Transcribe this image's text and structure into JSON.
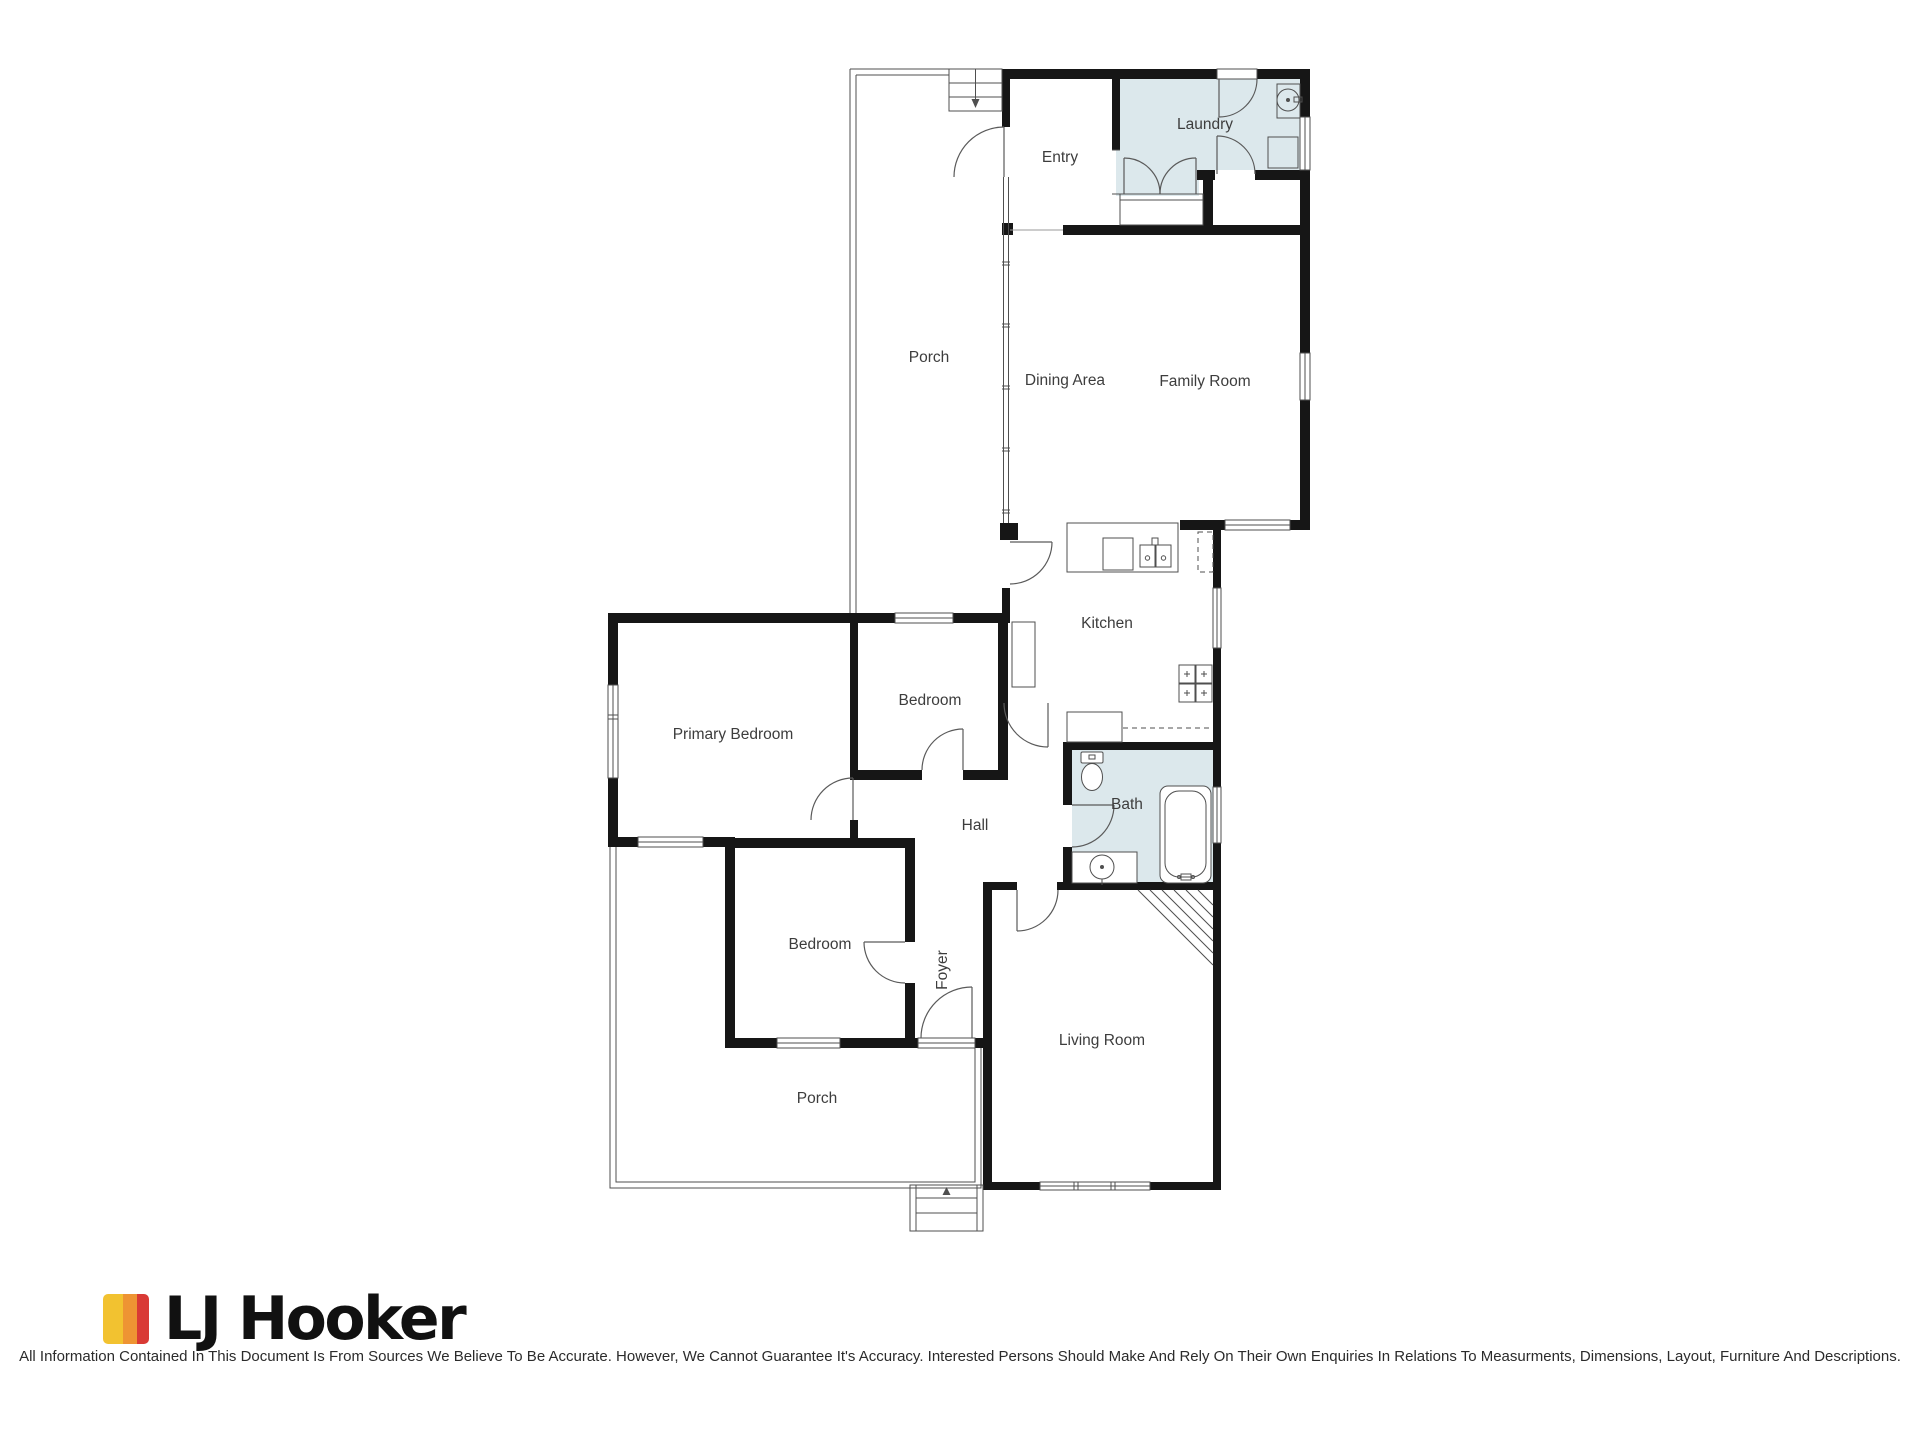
{
  "floorplan": {
    "rooms": [
      {
        "name": "porch-upper",
        "label": "Porch"
      },
      {
        "name": "entry",
        "label": "Entry"
      },
      {
        "name": "laundry",
        "label": "Laundry"
      },
      {
        "name": "dining-area",
        "label": "Dining Area"
      },
      {
        "name": "family-room",
        "label": "Family Room"
      },
      {
        "name": "kitchen",
        "label": "Kitchen"
      },
      {
        "name": "primary-bedroom",
        "label": "Primary Bedroom"
      },
      {
        "name": "bedroom-middle",
        "label": "Bedroom"
      },
      {
        "name": "hall",
        "label": "Hall"
      },
      {
        "name": "bath",
        "label": "Bath"
      },
      {
        "name": "bedroom-lower",
        "label": "Bedroom"
      },
      {
        "name": "foyer",
        "label": "Foyer"
      },
      {
        "name": "living-room",
        "label": "Living Room"
      },
      {
        "name": "porch-lower",
        "label": "Porch"
      }
    ],
    "fixtures": [
      "stairs-down",
      "front-steps",
      "corner-stairs",
      "toilet",
      "bathtub",
      "vanity-sink",
      "kitchen-double-sink",
      "stove",
      "cooktop",
      "refrigerator",
      "dishwasher",
      "laundry-sink",
      "washer",
      "linen-closet"
    ],
    "colors": {
      "wall": "#161616",
      "wet_room_fill": "#dce8ec",
      "line": "#4f4f4f",
      "label": "#3d3d3d"
    }
  },
  "footer": {
    "brand": {
      "name": "LJ Hooker",
      "stripe_colors": [
        "#F2C230",
        "#EE9433",
        "#D93A35"
      ]
    },
    "disclaimer": "All Information Contained In This Document Is From Sources We Believe To Be Accurate. However, We Cannot Guarantee It's Accuracy. Interested Persons Should Make And Rely On Their Own Enquiries In Relations To Measurments, Dimensions, Layout, Furniture And Descriptions."
  }
}
